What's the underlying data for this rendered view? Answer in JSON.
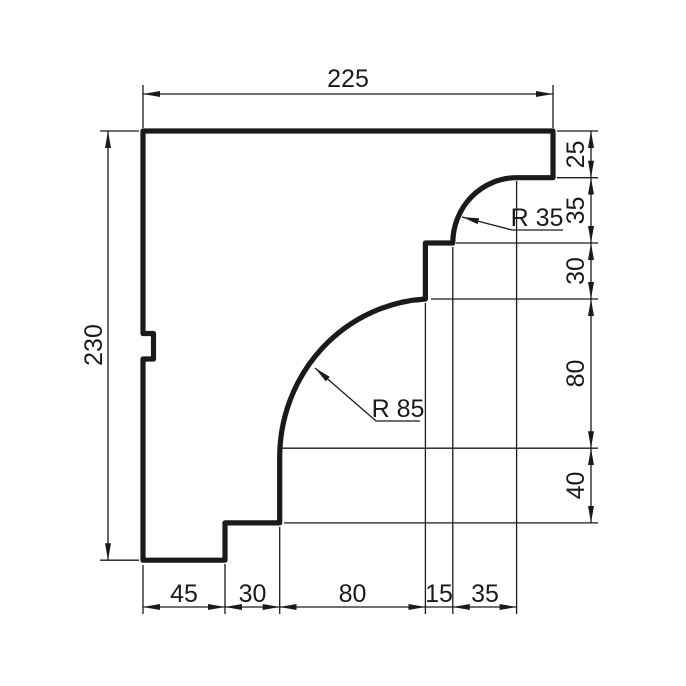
{
  "drawing": {
    "background_color": "#ffffff",
    "line_color": "#1a1a1a",
    "text_color": "#1a1a1a",
    "dimensions": {
      "top_width": "225",
      "left_height": "230",
      "right_side": [
        "25",
        "35",
        "30",
        "80",
        "40"
      ],
      "bottom_side": [
        "45",
        "30",
        "80",
        "15",
        "35"
      ]
    },
    "radius_labels": {
      "small_arc": "R 35",
      "large_arc": "R 85"
    }
  }
}
